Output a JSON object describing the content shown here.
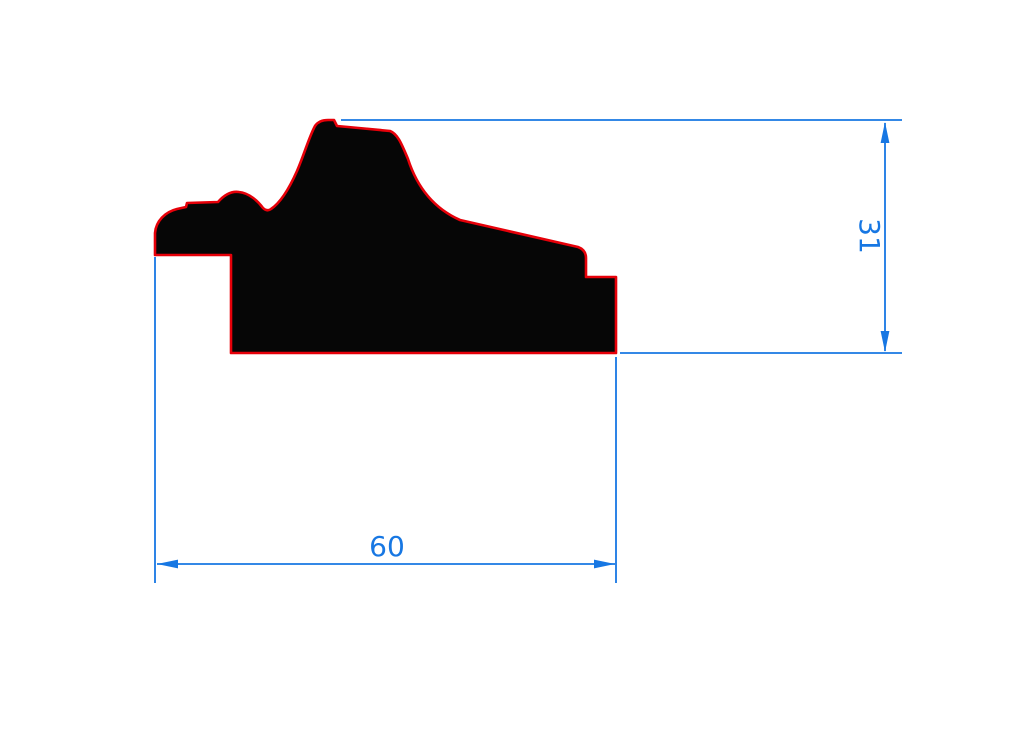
{
  "page": {
    "background_color": "#ffffff"
  },
  "drawing": {
    "description": "Technical cross-section profile drawing of a picture frame moulding with dimension lines",
    "profile": {
      "path": "M 155,255 L 155,233 C 156,221 165,212 177,209 L 186,207 L 187,203 L 218,202 C 225,194 232,191 239,192 C 249,193 258,201 263,208 Q 267,212 271,209 C 280,203 289,189 297,171 C 304,155 309,137 315,126 Q 319,120 328,120 L 334,120 L 337,126 L 348,127 L 390,131 C 398,134 402,145 408,159 C 417,187 433,208 460,220 L 578,247 Q 586,250 586,258 L 586,277 L 616,277 L 616,353 L 231,353 L 231,255 Z",
      "fill_color": "#060606",
      "outline_color": "#e60009"
    },
    "dimensions": {
      "color": "#1777e3",
      "width": {
        "value": "60",
        "orientation": "horizontal"
      },
      "height": {
        "value": "31",
        "orientation": "vertical"
      }
    }
  }
}
